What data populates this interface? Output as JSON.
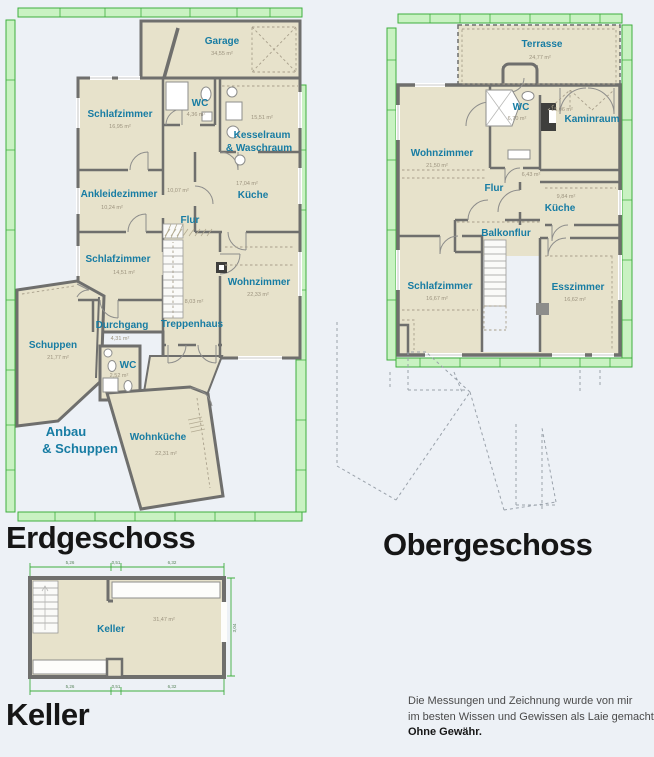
{
  "canvas": {
    "width": 654,
    "height": 757
  },
  "colors": {
    "background": "#edf1f6",
    "floor_fill": "#e7e2cb",
    "wall": "#6f6f6d",
    "room_label": "#177ca3",
    "area_label": "#9c937f",
    "dim_bar_fill": "#c9f2c2",
    "dim_bar_stroke": "#3fae3f",
    "title": "#161616",
    "disclaimer": "#4a4a4a"
  },
  "floors": {
    "eg": {
      "title": "Erdgeschoss",
      "rooms": [
        {
          "name": "Garage",
          "area": "34,55 m²"
        },
        {
          "name": "Schlafzimmer",
          "area": "16,95 m²"
        },
        {
          "name": "WC",
          "area": "4,36 m²"
        },
        {
          "name": "Kesselraum",
          "name2": "& Waschraum",
          "area": "15,51 m²"
        },
        {
          "name": "Ankleidezimmer",
          "area": "10,24 m²"
        },
        {
          "name": "Flur",
          "area": "10,07 m²"
        },
        {
          "name": "Küche",
          "area": "17,04 m²"
        },
        {
          "name": "Schlafzimmer",
          "area": "14,51 m²"
        },
        {
          "name": "Wohnzimmer",
          "area": "22,33 m²"
        },
        {
          "name": "Treppenhaus",
          "area": "8,03 m²"
        },
        {
          "name": "Durchgang",
          "area": "4,31 m²"
        },
        {
          "name": "Schuppen",
          "area": "21,77 m²"
        },
        {
          "name": "WC",
          "area": "2,52 m²"
        },
        {
          "name": "Anbau",
          "name2": "& Schuppen"
        },
        {
          "name": "Wohnküche",
          "area": "22,31 m²"
        }
      ]
    },
    "og": {
      "title": "Obergeschoss",
      "rooms": [
        {
          "name": "Terrasse",
          "area": "24,77 m²"
        },
        {
          "name": "Wohnzimmer",
          "area": "21,50 m²"
        },
        {
          "name": "WC",
          "area": "6,70 m²"
        },
        {
          "name": "Kaminraum",
          "area": "15,06 m²"
        },
        {
          "name": "Flur",
          "area": "6,43 m²"
        },
        {
          "name": "Küche",
          "area": "9,84 m²"
        },
        {
          "name": "Balkonflur"
        },
        {
          "name": "Schlafzimmer",
          "area": "16,67 m²"
        },
        {
          "name": "Esszimmer",
          "area": "16,62 m²"
        }
      ]
    },
    "kg": {
      "title": "Keller",
      "rooms": [
        {
          "name": "Keller",
          "area": "31,47 m²"
        }
      ],
      "dims": {
        "top": [
          "5,26",
          "0,51",
          "6,32"
        ],
        "bottom": [
          "5,26",
          "0,51",
          "6,32"
        ],
        "left": "3,04",
        "right": "3,04"
      }
    }
  },
  "disclaimer": {
    "line1": "Die Messungen und Zeichnung wurde von mir",
    "line2": "im besten Wissen und Gewissen als Laie gemacht.",
    "line3": "Ohne Gewähr."
  }
}
